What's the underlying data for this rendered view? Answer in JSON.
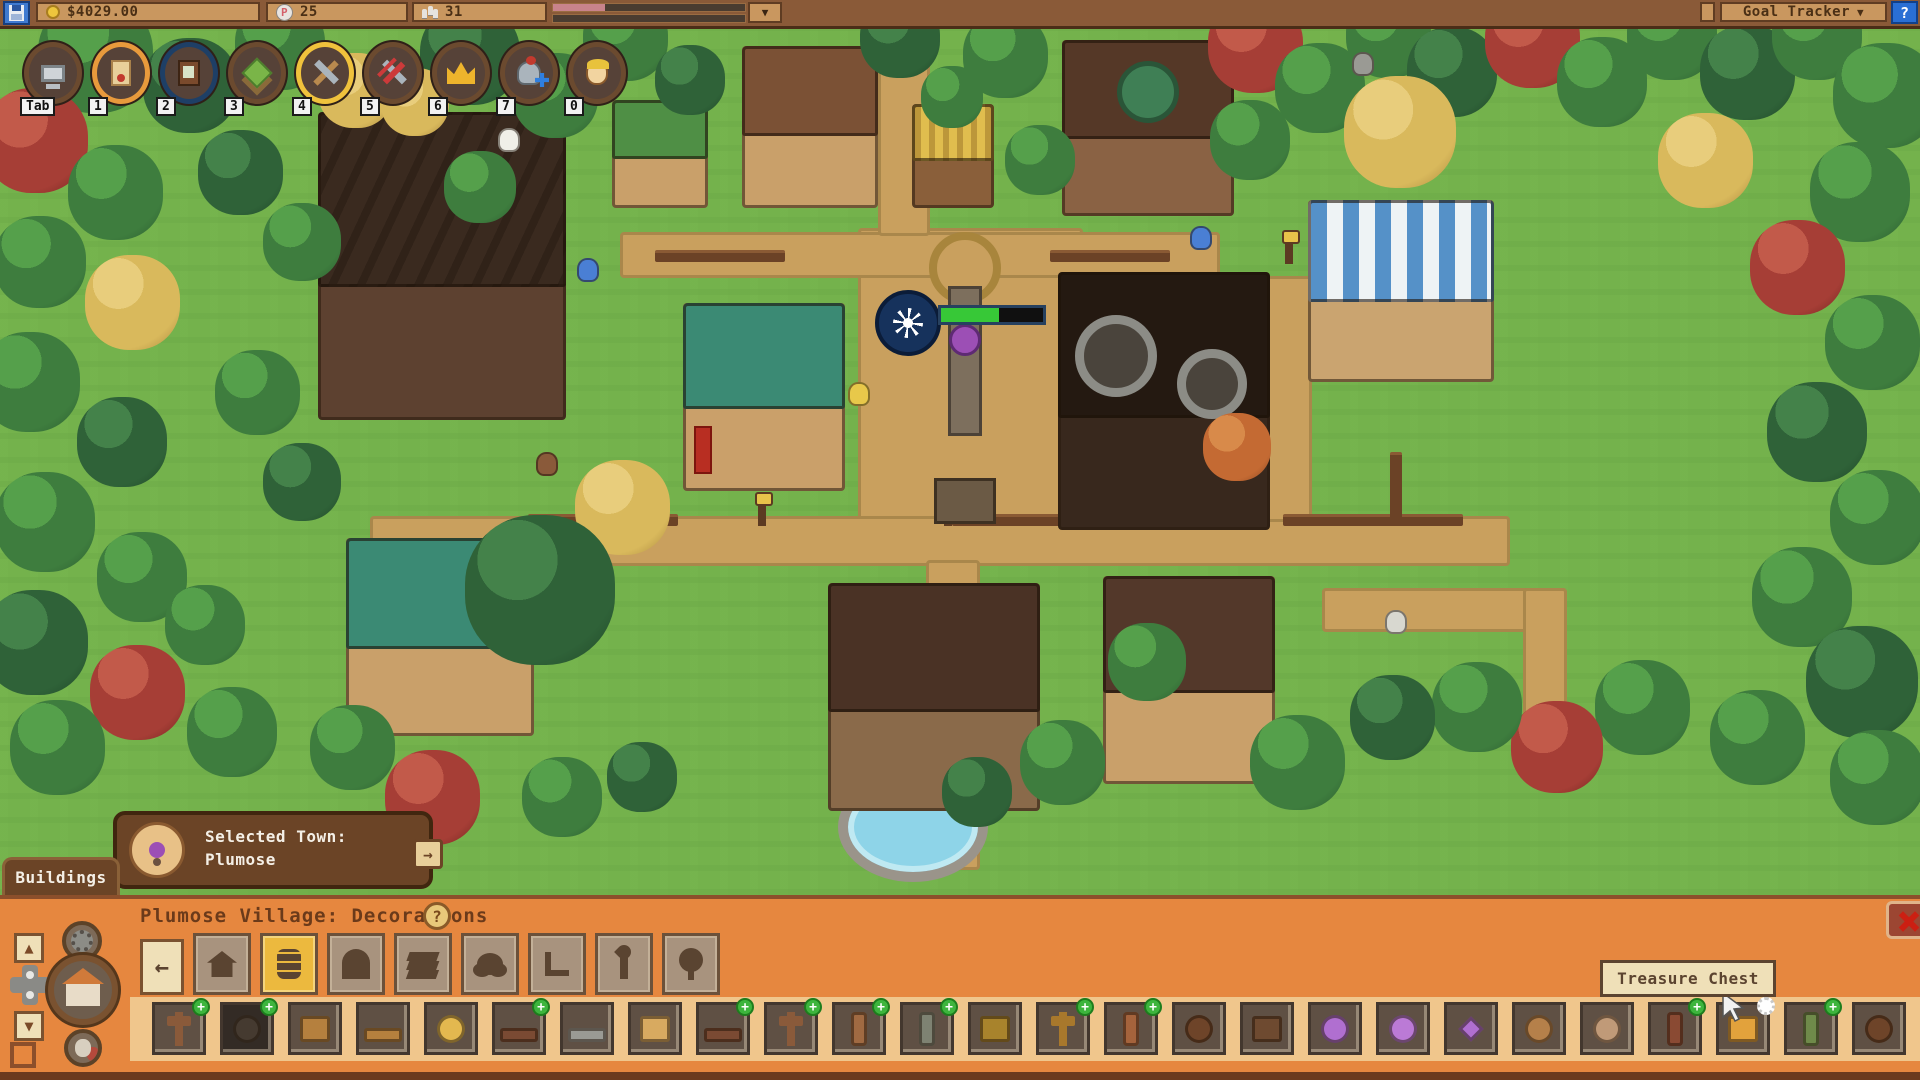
{
  "top_bar": {
    "money": "$4029.00",
    "p_token_count": "25",
    "population_count": "31",
    "mood_fill_pct": 27,
    "goal_tracker_label": "Goal Tracker",
    "help_label": "?"
  },
  "icons": {
    "caret_down": "▼",
    "arrow_up": "▲",
    "arrow_down": "▼",
    "arrow_right": "→",
    "arrow_back": "←",
    "plus": "+",
    "help": "?"
  },
  "hotbar": {
    "slots": [
      {
        "key": "Tab",
        "icon": "computer-icon",
        "ring": "#6b4a2f"
      },
      {
        "key": "1",
        "icon": "scroll-icon",
        "ring": "#e89a3c"
      },
      {
        "key": "2",
        "icon": "journal-icon",
        "ring": "#1e3f66"
      },
      {
        "key": "3",
        "icon": "terrain-icon",
        "ring": "#6b4a2f"
      },
      {
        "key": "4",
        "icon": "tools-icon",
        "ring": "#f0c23c"
      },
      {
        "key": "5",
        "icon": "demolish-icon",
        "ring": "#6b4a2f"
      },
      {
        "key": "6",
        "icon": "crown-icon",
        "ring": "#6b4a2f"
      },
      {
        "key": "7",
        "icon": "armor-icon",
        "ring": "#6b4a2f"
      },
      {
        "key": "0",
        "icon": "character-icon",
        "ring": "#6b4a2f"
      }
    ]
  },
  "player": {
    "health_pct": 57
  },
  "selected_town": {
    "label": "Selected Town:",
    "town_name": "Plumose"
  },
  "buildings_tab_label": "Buildings",
  "bottom_panel": {
    "title": "Plumose Village: Decorations",
    "help_label": "?",
    "tooltip": "Treasure Chest",
    "tabs": [
      {
        "name": "back",
        "icon": "back-arrow-icon"
      },
      {
        "name": "houses",
        "icon": "house-icon"
      },
      {
        "name": "decorations",
        "icon": "barrel-icon",
        "selected": true
      },
      {
        "name": "gates",
        "icon": "arch-icon"
      },
      {
        "name": "flooring",
        "icon": "layers-icon"
      },
      {
        "name": "bushes",
        "icon": "bush-icon"
      },
      {
        "name": "furniture",
        "icon": "chair-icon"
      },
      {
        "name": "torches",
        "icon": "torch-icon"
      },
      {
        "name": "trees",
        "icon": "tree-icon"
      }
    ],
    "items": [
      {
        "name": "wood-signpost",
        "plus": true,
        "shape": "post",
        "color": "#8a5a3a"
      },
      {
        "name": "stone-well",
        "plus": true,
        "shape": "round",
        "color": "#453a30",
        "dark": true
      },
      {
        "name": "wooden-box",
        "plus": false,
        "shape": "box",
        "color": "#b5803e"
      },
      {
        "name": "wooden-shelf",
        "plus": false,
        "shape": "wide",
        "color": "#b5803e"
      },
      {
        "name": "hay-bale",
        "plus": false,
        "shape": "round",
        "color": "#e3b84f"
      },
      {
        "name": "wooden-bench",
        "plus": true,
        "shape": "wide",
        "color": "#7a4a33"
      },
      {
        "name": "stone-bench",
        "plus": false,
        "shape": "wide",
        "color": "#9a9a94"
      },
      {
        "name": "knapsack",
        "plus": false,
        "shape": "box",
        "color": "#d8aa60"
      },
      {
        "name": "log-bench",
        "plus": true,
        "shape": "wide",
        "color": "#7a4a33"
      },
      {
        "name": "signpost-arm",
        "plus": true,
        "shape": "post",
        "color": "#8a5a3a"
      },
      {
        "name": "log-stump",
        "plus": true,
        "shape": "pillar",
        "color": "#a06a42"
      },
      {
        "name": "mossy-pillar",
        "plus": true,
        "shape": "pillar",
        "color": "#7e8272"
      },
      {
        "name": "sign-board",
        "plus": false,
        "shape": "box",
        "color": "#a8832c"
      },
      {
        "name": "tall-signpost",
        "plus": true,
        "shape": "post",
        "color": "#a8782c"
      },
      {
        "name": "wood-totem",
        "plus": true,
        "shape": "pillar",
        "color": "#a5633c"
      },
      {
        "name": "beehive",
        "plus": false,
        "shape": "round",
        "color": "#6e4429"
      },
      {
        "name": "banded-chest",
        "plus": false,
        "shape": "box",
        "color": "#6e4a30"
      },
      {
        "name": "amethyst-egg",
        "plus": false,
        "shape": "round",
        "color": "#b06fd0"
      },
      {
        "name": "amethyst-orb",
        "plus": false,
        "shape": "round",
        "color": "#bb7ad6"
      },
      {
        "name": "crystal-cluster",
        "plus": false,
        "shape": "crystal",
        "color": "#b06fd0"
      },
      {
        "name": "gem-basket",
        "plus": false,
        "shape": "round",
        "color": "#b5804a"
      },
      {
        "name": "purple-cushion",
        "plus": false,
        "shape": "round",
        "color": "#c09a78"
      },
      {
        "name": "charm-totem",
        "plus": true,
        "shape": "pillar",
        "color": "#8a4a33"
      },
      {
        "name": "treasure-chest",
        "plus": false,
        "shape": "box",
        "color": "#e2a23c",
        "gear": true,
        "hover": true
      },
      {
        "name": "skull-stump",
        "plus": true,
        "shape": "pillar",
        "color": "#6f8a4a"
      },
      {
        "name": "acorn-hive",
        "plus": false,
        "shape": "round",
        "color": "#6e4429"
      },
      {
        "name": "wood-chair",
        "plus": false,
        "shape": "wide",
        "color": "#a06a38"
      }
    ]
  },
  "map": {
    "palette": {
      "g": [
        "#55a04b",
        "#3e7d3e",
        "#2c5c30"
      ],
      "dg": [
        "#44824a",
        "#2f6238",
        "#1f4628"
      ],
      "r": [
        "#c25a4a",
        "#a63e36",
        "#71251f"
      ],
      "o": [
        "#d88a4a",
        "#c46a33",
        "#8a4520"
      ],
      "y": [
        "#e8cd7c",
        "#d9b95c",
        "#a8853c"
      ]
    },
    "trees": [
      [
        95,
        55,
        115,
        "g"
      ],
      [
        190,
        85,
        95,
        "dg"
      ],
      [
        280,
        45,
        90,
        "g"
      ],
      [
        355,
        90,
        75,
        "y"
      ],
      [
        470,
        55,
        100,
        "dg"
      ],
      [
        555,
        95,
        85,
        "g"
      ],
      [
        625,
        38,
        85,
        "g"
      ],
      [
        690,
        80,
        70,
        "dg"
      ],
      [
        900,
        38,
        80,
        "dg"
      ],
      [
        1005,
        55,
        85,
        "g"
      ],
      [
        1040,
        160,
        70,
        "g"
      ],
      [
        1255,
        45,
        95,
        "r"
      ],
      [
        1320,
        88,
        90,
        "g"
      ],
      [
        1388,
        35,
        85,
        "g"
      ],
      [
        1452,
        72,
        90,
        "dg"
      ],
      [
        1532,
        40,
        95,
        "r"
      ],
      [
        1602,
        82,
        90,
        "g"
      ],
      [
        1672,
        35,
        90,
        "g"
      ],
      [
        1747,
        72,
        95,
        "dg"
      ],
      [
        1817,
        35,
        90,
        "g"
      ],
      [
        1885,
        95,
        105,
        "g"
      ],
      [
        1705,
        160,
        95,
        "y"
      ],
      [
        1250,
        140,
        80,
        "g"
      ],
      [
        35,
        140,
        105,
        "r"
      ],
      [
        115,
        192,
        95,
        "g"
      ],
      [
        40,
        262,
        92,
        "g"
      ],
      [
        132,
        302,
        95,
        "y"
      ],
      [
        30,
        382,
        100,
        "g"
      ],
      [
        122,
        442,
        90,
        "dg"
      ],
      [
        45,
        522,
        100,
        "g"
      ],
      [
        142,
        577,
        90,
        "g"
      ],
      [
        35,
        642,
        105,
        "dg"
      ],
      [
        137,
        692,
        95,
        "r"
      ],
      [
        232,
        732,
        90,
        "g"
      ],
      [
        57,
        747,
        95,
        "g"
      ],
      [
        240,
        172,
        85,
        "dg"
      ],
      [
        302,
        242,
        78,
        "g"
      ],
      [
        257,
        392,
        85,
        "g"
      ],
      [
        302,
        482,
        78,
        "dg"
      ],
      [
        205,
        625,
        80,
        "g"
      ],
      [
        1860,
        192,
        100,
        "g"
      ],
      [
        1797,
        267,
        95,
        "r"
      ],
      [
        1872,
        342,
        95,
        "g"
      ],
      [
        1817,
        432,
        100,
        "dg"
      ],
      [
        1877,
        517,
        95,
        "g"
      ],
      [
        1802,
        597,
        100,
        "g"
      ],
      [
        1862,
        682,
        112,
        "dg"
      ],
      [
        1757,
        737,
        95,
        "g"
      ],
      [
        1642,
        707,
        95,
        "g"
      ],
      [
        1557,
        747,
        92,
        "r"
      ],
      [
        1477,
        707,
        90,
        "g"
      ],
      [
        1877,
        777,
        95,
        "g"
      ],
      [
        480,
        187,
        72,
        "g"
      ],
      [
        415,
        102,
        68,
        "y"
      ],
      [
        952,
        97,
        62,
        "g"
      ],
      [
        1400,
        132,
        112,
        "y"
      ],
      [
        622,
        507,
        95,
        "y"
      ],
      [
        1237,
        447,
        68,
        "o"
      ],
      [
        1147,
        662,
        78,
        "g"
      ],
      [
        1297,
        762,
        95,
        "g"
      ],
      [
        1392,
        717,
        85,
        "dg"
      ],
      [
        432,
        797,
        95,
        "r"
      ],
      [
        352,
        747,
        85,
        "g"
      ],
      [
        562,
        797,
        80,
        "g"
      ],
      [
        642,
        777,
        70,
        "dg"
      ],
      [
        1062,
        762,
        85,
        "g"
      ],
      [
        977,
        792,
        70,
        "dg"
      ],
      [
        540,
        590,
        150,
        "dg"
      ]
    ],
    "paths": [
      {
        "x": 858,
        "y": 228,
        "w": 225,
        "h": 335
      },
      {
        "x": 620,
        "y": 232,
        "w": 600,
        "h": 46
      },
      {
        "x": 370,
        "y": 516,
        "w": 1140,
        "h": 50
      },
      {
        "x": 878,
        "y": 60,
        "w": 52,
        "h": 176
      },
      {
        "x": 926,
        "y": 560,
        "w": 54,
        "h": 310
      },
      {
        "x": 1262,
        "y": 276,
        "w": 50,
        "h": 246
      },
      {
        "x": 1322,
        "y": 588,
        "w": 245,
        "h": 44
      },
      {
        "x": 1523,
        "y": 588,
        "w": 44,
        "h": 140
      }
    ],
    "fences": [
      {
        "x": 528,
        "y": 514,
        "w": 150,
        "h": 12
      },
      {
        "x": 952,
        "y": 514,
        "w": 130,
        "h": 12
      },
      {
        "x": 1118,
        "y": 514,
        "w": 150,
        "h": 12
      },
      {
        "x": 1283,
        "y": 514,
        "w": 180,
        "h": 12
      },
      {
        "x": 655,
        "y": 250,
        "w": 130,
        "h": 12
      },
      {
        "x": 1050,
        "y": 250,
        "w": 120,
        "h": 12
      },
      {
        "x": 1390,
        "y": 452,
        "w": 12,
        "h": 70
      },
      {
        "x": 588,
        "y": 558,
        "w": 12,
        "h": 60
      }
    ],
    "buildings": [
      {
        "name": "grand-lodge",
        "type": "lodge",
        "x": 318,
        "y": 112,
        "w": 248,
        "h": 308,
        "wall": "#5d4130",
        "roof": "#3a2a1f"
      },
      {
        "name": "green-hut",
        "type": "roofed",
        "x": 612,
        "y": 100,
        "w": 96,
        "h": 108,
        "wall": "#c9a06a",
        "roof": "#4f8f45"
      },
      {
        "name": "tailor-shop",
        "type": "roofed",
        "x": 742,
        "y": 46,
        "w": 136,
        "h": 162,
        "wall": "#c9a06a",
        "roof": "#7b5135"
      },
      {
        "name": "produce-stand",
        "type": "stall",
        "x": 912,
        "y": 104,
        "w": 82,
        "h": 104,
        "wall": "#8a5f3a",
        "roof": "#e0bd4e"
      },
      {
        "name": "town-hall",
        "type": "hall",
        "x": 1062,
        "y": 40,
        "w": 172,
        "h": 176,
        "wall": "#8a6244",
        "roof": "#553827"
      },
      {
        "name": "awning-shop",
        "type": "awning",
        "x": 1308,
        "y": 200,
        "w": 186,
        "h": 182,
        "wall": "#caa470",
        "roof": "#b8894e"
      },
      {
        "name": "gear-mill",
        "type": "mill",
        "x": 1058,
        "y": 272,
        "w": 212,
        "h": 258,
        "wall": "#38281d",
        "roof": "#241911"
      },
      {
        "name": "lantern-shop",
        "type": "lantern",
        "x": 683,
        "y": 303,
        "w": 162,
        "h": 188,
        "wall": "#caa06a",
        "roof": "#3b8a74"
      },
      {
        "name": "teal-house",
        "type": "roofed",
        "x": 346,
        "y": 538,
        "w": 188,
        "h": 198,
        "wall": "#c9a06a",
        "roof": "#3b8a74"
      },
      {
        "name": "onsen-house",
        "type": "roofed",
        "x": 828,
        "y": 583,
        "w": 212,
        "h": 228,
        "wall": "#8a6a4a",
        "roof": "#4a3225"
      },
      {
        "name": "statue-house",
        "type": "roofed",
        "x": 1103,
        "y": 576,
        "w": 172,
        "h": 208,
        "wall": "#c9a06a",
        "roof": "#53382a"
      }
    ],
    "lamps": [
      {
        "x": 636,
        "y": 500
      },
      {
        "x": 944,
        "y": 500
      },
      {
        "x": 1204,
        "y": 500
      },
      {
        "x": 1285,
        "y": 238
      },
      {
        "x": 758,
        "y": 500
      }
    ],
    "npcs": [
      {
        "name": "blue-slime-1",
        "x": 577,
        "y": 258,
        "c": "#4a7fd4"
      },
      {
        "name": "blue-slime-2",
        "x": 1190,
        "y": 226,
        "c": "#4a7fd4"
      },
      {
        "name": "villager-brown",
        "x": 536,
        "y": 452,
        "c": "#8a5a3a"
      },
      {
        "name": "villager-blond",
        "x": 848,
        "y": 382,
        "c": "#e8c84a"
      },
      {
        "name": "monk-villager",
        "x": 1385,
        "y": 610,
        "c": "#d8d8d0"
      },
      {
        "name": "chicken",
        "x": 498,
        "y": 128,
        "c": "#f0f0e8"
      },
      {
        "name": "stone-statue",
        "x": 1352,
        "y": 52,
        "c": "#9a9a94"
      }
    ]
  }
}
